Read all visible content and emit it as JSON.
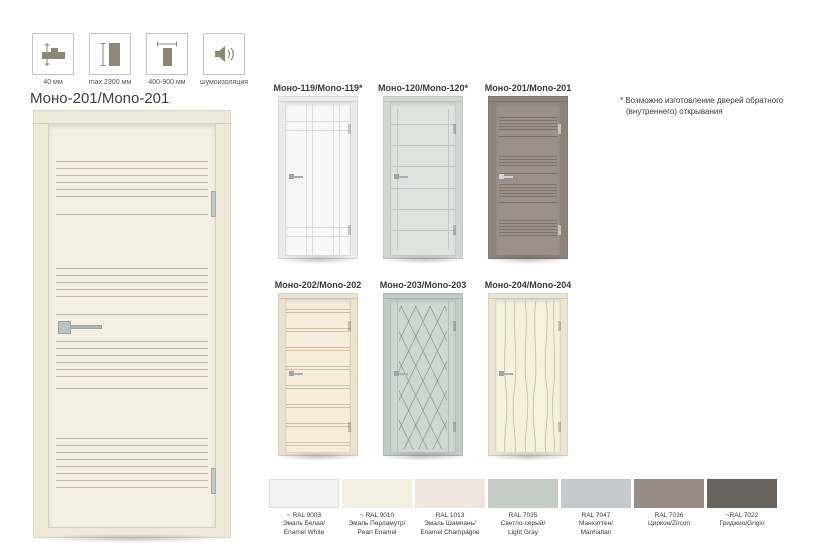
{
  "specs": {
    "items": [
      {
        "icon": "door-thickness-icon",
        "label": "40 мм"
      },
      {
        "icon": "door-height-icon",
        "label": "max 2300 мм"
      },
      {
        "icon": "door-width-icon",
        "label": "400-900 мм"
      },
      {
        "icon": "sound-insulation-icon",
        "label": "шумоизоляция"
      }
    ]
  },
  "main_door": {
    "title": "Моно-201/Mono-201",
    "leaf": "#f4efe2",
    "jamb": "#efe9da"
  },
  "thumbnails": [
    {
      "title": "Моно-119/Mono-119*",
      "leaf": "#f7f7f7",
      "jamb": "#ebebeb"
    },
    {
      "title": "Моно-120/Mono-120*",
      "leaf": "#dee3e0",
      "jamb": "#d2d7d4"
    },
    {
      "title": "Моно-201/Mono-201",
      "leaf": "#9b918a",
      "jamb": "#8b827b"
    },
    {
      "title": "Моно-202/Mono-202",
      "leaf": "#f6ecdb",
      "jamb": "#ebe1cf"
    },
    {
      "title": "Моно-203/Mono-203",
      "leaf": "#cdd7d1",
      "jamb": "#c1cbc5"
    },
    {
      "title": "Моно-204/Mono-204",
      "leaf": "#f5f0df",
      "jamb": "#eae5d3"
    }
  ],
  "note": {
    "lines": [
      "* Возможно изготовление дверей обратного",
      "(внутреннего) открывания"
    ]
  },
  "swatches": [
    {
      "color": "#f2f2f2",
      "lines": [
        "~ RAL 9003",
        "Эмаль Белая/",
        "Enamel White"
      ]
    },
    {
      "color": "#f4efe3",
      "lines": [
        "~ RAL 9010",
        "Эмаль Перламутр/",
        "Pearl Enamel"
      ]
    },
    {
      "color": "#efe5df",
      "lines": [
        "RAL 1013",
        "Эмаль Шампань/",
        "Enamel Champagne"
      ]
    },
    {
      "color": "#c4cec7",
      "lines": [
        "RAL 7035",
        "Светло-серый/",
        "Light Gray"
      ]
    },
    {
      "color": "#c6c9cb",
      "lines": [
        "RAL 7047",
        "Манхэттен/",
        "Manhattan"
      ]
    },
    {
      "color": "#978c85",
      "lines": [
        "RAL 7036",
        "Циркон/Zircon"
      ]
    },
    {
      "color": "#6a645e",
      "lines": [
        "~RAL 7022",
        "Гриджио/Grigio"
      ]
    }
  ]
}
